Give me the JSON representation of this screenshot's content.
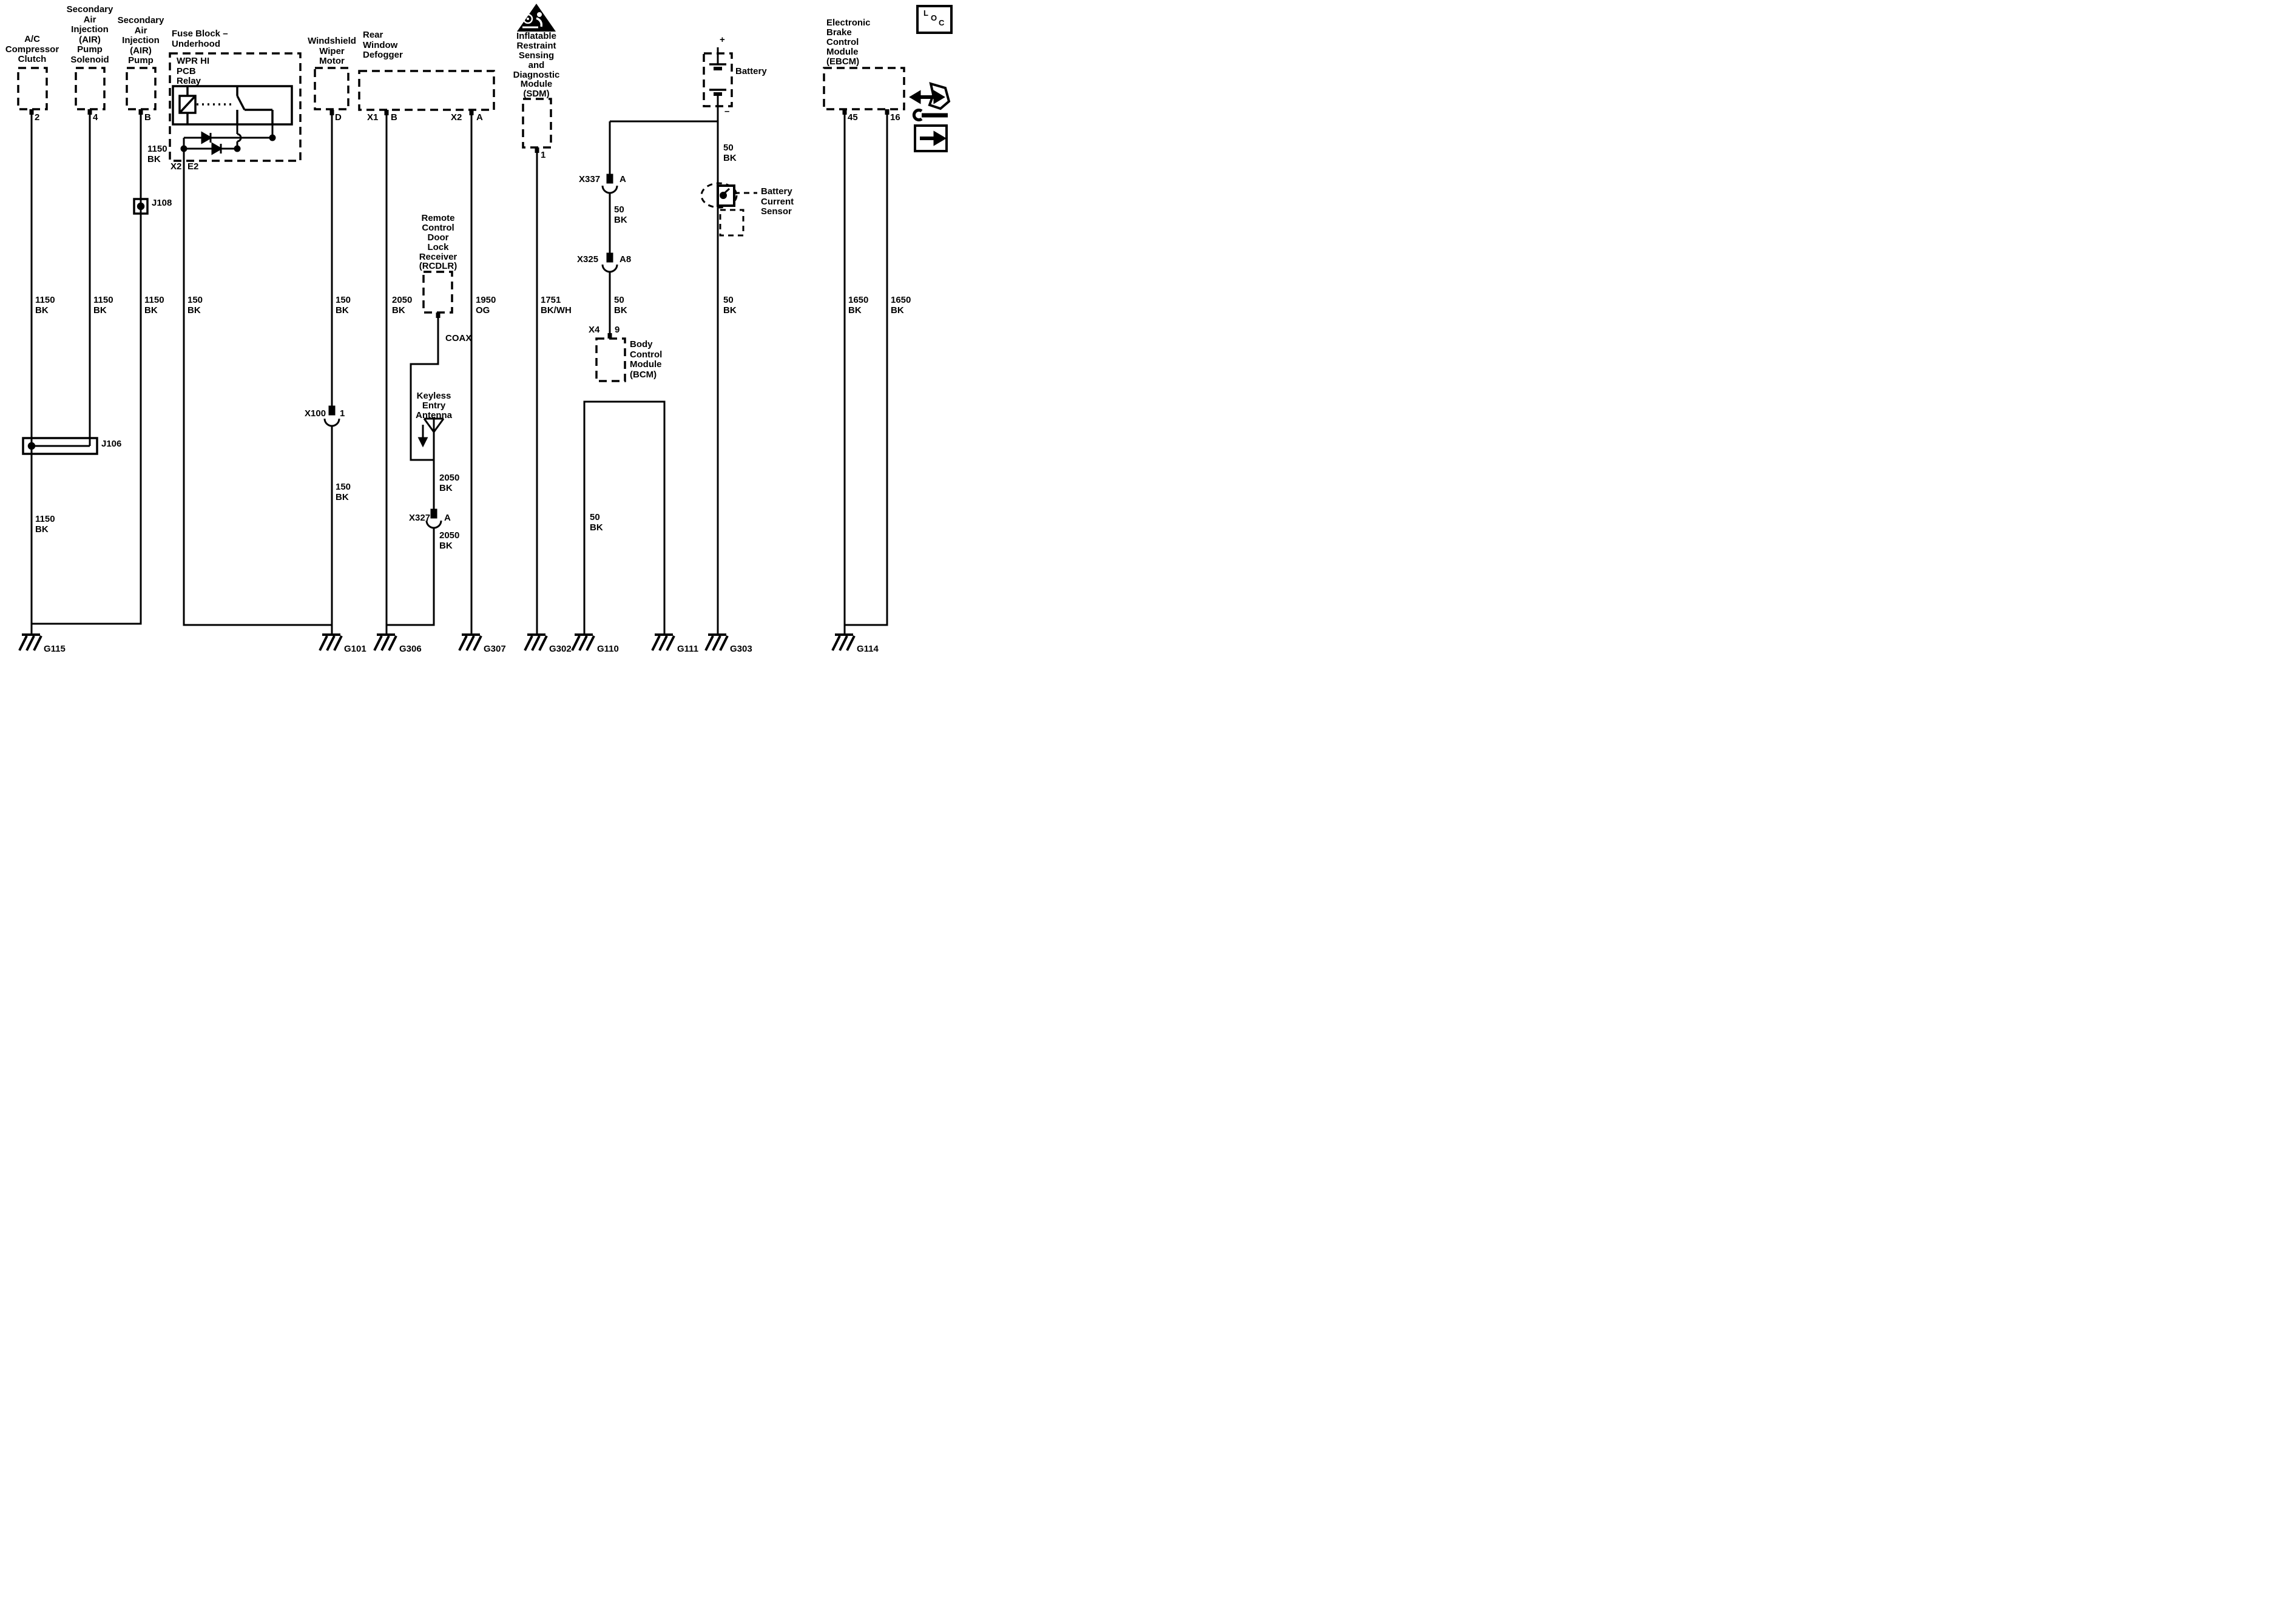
{
  "components": {
    "acc": {
      "label": "A/C\nCompressor\nClutch",
      "pin": "2"
    },
    "sol": {
      "label": "Secondary\nAir\nInjection\n(AIR)\nPump\nSolenoid",
      "pin": "4"
    },
    "pump": {
      "label": "Secondary\nAir\nInjection\n(AIR)\nPump",
      "pin": "B"
    },
    "fuse": {
      "label": "Fuse Block –\nUnderhood",
      "relay": "WPR HI\nPCB\nRelay",
      "conn": "X2",
      "pin": "E2"
    },
    "wiper": {
      "label": "Windshield\nWiper\nMotor",
      "pin": "D"
    },
    "defogger": {
      "label": "Rear\nWindow\nDefogger",
      "conn1": "X1",
      "pin1": "B",
      "conn2": "X2",
      "pin2": "A"
    },
    "sdm": {
      "label": "Inflatable\nRestraint\nSensing\nand\nDiagnostic\nModule\n(SDM)",
      "pin": "1"
    },
    "battery": {
      "label": "Battery",
      "plus": "+",
      "minus": "–"
    },
    "ebcm": {
      "label": "Electronic\nBrake\nControl\nModule\n(EBCM)",
      "pin1": "45",
      "pin2": "16"
    },
    "rcdlr": {
      "label": "Remote\nControl\nDoor\nLock\nReceiver\n(RCDLR)"
    },
    "antenna": {
      "label": "Keyless\nEntry\nAntenna"
    },
    "bcm": {
      "label": "Body\nControl\nModule\n(BCM)",
      "conn": "X4",
      "pin": "9"
    },
    "sensor": {
      "label": "Battery\nCurrent\nSensor"
    }
  },
  "junctions": {
    "j106": "J106",
    "j108": "J108"
  },
  "connectors": {
    "x100": {
      "name": "X100",
      "pin": "1"
    },
    "x327": {
      "name": "X327",
      "pin": "A"
    },
    "x337": {
      "name": "X337",
      "pin": "A"
    },
    "x325": {
      "name": "X325",
      "pin": "A8"
    }
  },
  "wire_labels": {
    "acc1": "1150\nBK",
    "acc2": "1150\nBK",
    "sol": "1150\nBK",
    "pump_top": "1150\nBK",
    "pump": "1150\nBK",
    "fuse_out": "150\nBK",
    "wiper1": "150\nBK",
    "wiper2": "150\nBK",
    "defog1": "2050\nBK",
    "defog2": "1950\nOG",
    "coax": "COAX",
    "ant1": "2050\nBK",
    "ant2": "2050\nBK",
    "sdm": "1751\nBK/WH",
    "chain1": "50\nBK",
    "chain2": "50\nBK",
    "bat1": "50\nBK",
    "bat2": "50\nBK",
    "u_left": "50\nBK",
    "ebcm1": "1650\nBK",
    "ebcm2": "1650\nBK"
  },
  "grounds": {
    "g115": "G115",
    "g101": "G101",
    "g306": "G306",
    "g307": "G307",
    "g302": "G302",
    "g110": "G110",
    "g111": "G111",
    "g303": "G303",
    "g114": "G114"
  },
  "icons": {
    "loc_l": "L",
    "loc_o": "O",
    "loc_c": "C"
  },
  "colors": {
    "line": "#000000",
    "background": "#ffffff"
  }
}
